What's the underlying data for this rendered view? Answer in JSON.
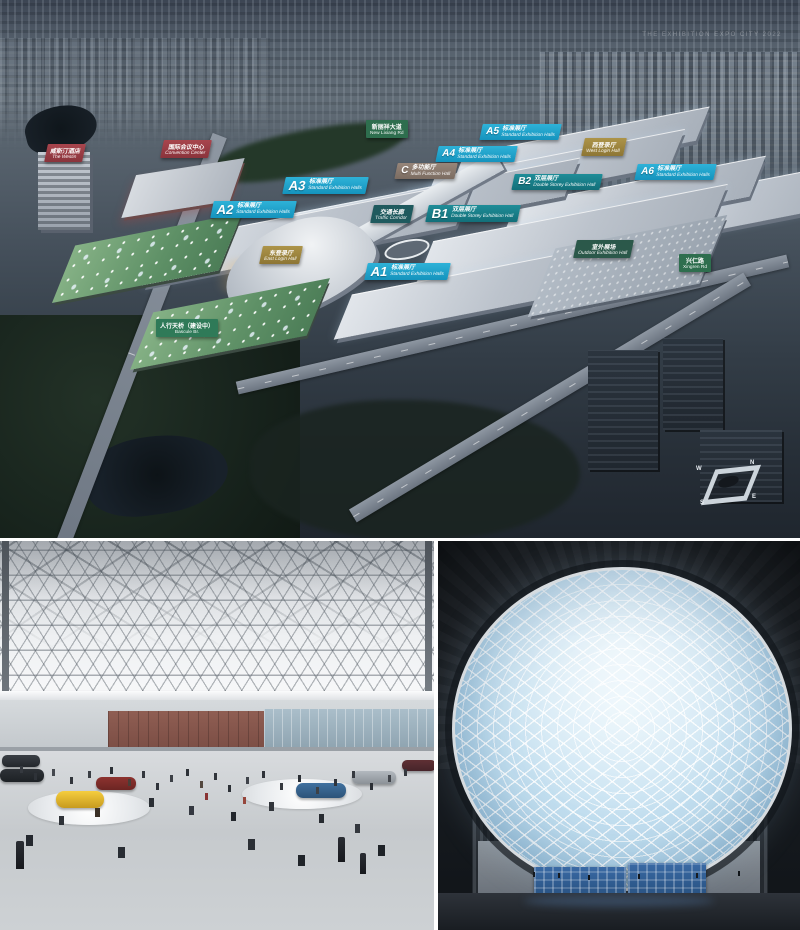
{
  "palette": {
    "hall_standard_cyan": "#1e9fc6",
    "hall_double_teal": "#177a85",
    "hall_multi_tan": "#8a7a6d",
    "login_gold": "#9d8440",
    "facility_red": "#9a3e46",
    "road_green": "#2e6e4e",
    "outdoor_dark_green": "#2b584a",
    "corridor_dark_teal": "#1f5a5e",
    "bridge_green": "#2f7a58",
    "dusk_sky": "#4b5663",
    "dome_sky": "#bedcee"
  },
  "aerial": {
    "watermark": "THE EXHIBITION EXPO CITY 2022",
    "compass": {
      "n": "N",
      "e": "E",
      "s": "S",
      "w": "W"
    },
    "labels": [
      {
        "letter": "A1",
        "zh": "标准展厅",
        "en": "Standard Exhibition Halls"
      },
      {
        "letter": "A2",
        "zh": "标准展厅",
        "en": "Standard Exhibition Halls"
      },
      {
        "letter": "A3",
        "zh": "标准展厅",
        "en": "Standard Exhibition Halls"
      },
      {
        "letter": "A4",
        "zh": "标准展厅",
        "en": "Standard Exhibition Halls"
      },
      {
        "letter": "A5",
        "zh": "标准展厅",
        "en": "Standard Exhibition Halls"
      },
      {
        "letter": "A6",
        "zh": "标准展厅",
        "en": "Standard Exhibition Halls"
      },
      {
        "letter": "B1",
        "zh": "双层展厅",
        "en": "Double Storey Exhibition Hall"
      },
      {
        "letter": "B2",
        "zh": "双层展厅",
        "en": "Double Storey Exhibition Hall"
      },
      {
        "letter": "C",
        "zh": "多功能厅",
        "en": "Multi Function Hall"
      },
      {
        "zh": "东登录厅",
        "en": "East Login Hall"
      },
      {
        "zh": "西登录厅",
        "en": "West Login Hall"
      },
      {
        "zh": "交通长廊",
        "en": "Traffic Corridor"
      },
      {
        "zh": "室外展场",
        "en": "Outdoor Exhibition Hall"
      },
      {
        "zh": "国际会议中心",
        "en": "Convention Center"
      },
      {
        "zh": "威斯汀酒店",
        "en": "The Westin"
      },
      {
        "zh": "新丽祥大道",
        "en": "New Lixiang Rd"
      },
      {
        "zh": "兴仁路",
        "en": "Xingren Rd"
      },
      {
        "zh": "人行天桥（建设中）",
        "en": "Bascule Br."
      }
    ]
  }
}
